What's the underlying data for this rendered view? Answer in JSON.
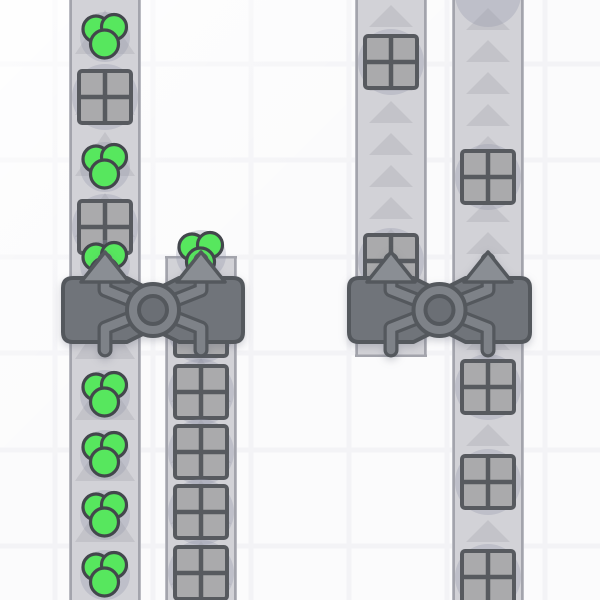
{
  "scene": {
    "canvas": {
      "width": 600,
      "height": 600
    },
    "colors": {
      "background": "#fbfbfc",
      "grid_line": "#f3f3f6",
      "belt_body": "#d2d2d7",
      "belt_edge": "#a3a4ac",
      "belt_arrow": "#c3c3c9",
      "item_shadow": "rgba(147,150,168,0.30)",
      "crate_fill": "#aaaaac",
      "crate_stroke": "#575a5f",
      "green_fill": "#57e75e",
      "green_stroke": "#43474c",
      "building_body": "#70747a",
      "building_stroke": "#54585d",
      "pipe_dark": "#54585d",
      "pipe_light": "#7e8288",
      "ring_inner_fill": "#6b6f75",
      "building_arrow_fill": "#8a8e94"
    },
    "grid": {
      "x_lines": [
        55,
        153,
        251,
        349,
        447,
        545
      ],
      "y_lines": [
        64,
        160,
        257,
        353,
        450,
        546
      ],
      "line_width": 5
    },
    "arrow_styles": {
      "large": {
        "w": 60,
        "h": 44
      },
      "small": {
        "w": 44,
        "h": 22
      }
    },
    "belts": [
      {
        "id": "belt-1",
        "x": 69,
        "width": 72,
        "y_top": 0,
        "y_bottom": 600,
        "arrow": "large",
        "spacing": 61,
        "phase": 10
      },
      {
        "id": "belt-2",
        "x": 165,
        "width": 72,
        "y_top": 256,
        "y_bottom": 600,
        "arrow": "large",
        "spacing": 61,
        "phase": 297
      },
      {
        "id": "belt-3",
        "x": 355,
        "width": 72,
        "y_top": 0,
        "y_bottom": 357,
        "arrow": "small",
        "spacing": 32,
        "phase": 5,
        "arrow_stop": 300
      },
      {
        "id": "belt-4",
        "x": 452,
        "width": 72,
        "y_top": 0,
        "y_bottom": 600,
        "arrow": "small",
        "spacing": 32,
        "phase": 8
      }
    ],
    "items": [
      {
        "type": "green",
        "x": 105,
        "y": 37
      },
      {
        "type": "crate",
        "x": 105,
        "y": 97
      },
      {
        "type": "green",
        "x": 105,
        "y": 167
      },
      {
        "type": "crate",
        "x": 105,
        "y": 227
      },
      {
        "type": "green",
        "x": 105,
        "y": 265
      },
      {
        "type": "green",
        "x": 105,
        "y": 395
      },
      {
        "type": "green",
        "x": 105,
        "y": 455
      },
      {
        "type": "green",
        "x": 105,
        "y": 515
      },
      {
        "type": "green",
        "x": 105,
        "y": 575
      },
      {
        "type": "green",
        "x": 201,
        "y": 255
      },
      {
        "type": "crate",
        "x": 201,
        "y": 330
      },
      {
        "type": "crate",
        "x": 201,
        "y": 392
      },
      {
        "type": "crate",
        "x": 201,
        "y": 452
      },
      {
        "type": "crate",
        "x": 201,
        "y": 512
      },
      {
        "type": "crate",
        "x": 201,
        "y": 573
      },
      {
        "type": "crate",
        "x": 391,
        "y": 62
      },
      {
        "type": "crate",
        "x": 391,
        "y": 261
      },
      {
        "type": "shadow",
        "x": 488,
        "y": -6
      },
      {
        "type": "crate",
        "x": 488,
        "y": 177
      },
      {
        "type": "crate",
        "x": 488,
        "y": 387
      },
      {
        "type": "crate",
        "x": 488,
        "y": 482
      },
      {
        "type": "crate",
        "x": 488,
        "y": 577
      }
    ],
    "buildings": [
      {
        "id": "crossover-left",
        "lane_a": 105,
        "lane_b": 201,
        "top": 278,
        "bottom": 342
      },
      {
        "id": "crossover-right",
        "lane_a": 391,
        "lane_b": 488,
        "top": 278,
        "bottom": 342
      }
    ],
    "building_geometry": {
      "side_extent": 42,
      "corner_radius": 10,
      "notch_half_width": 26,
      "notch_depth": 13,
      "ring_cy": 310,
      "ring_outer_r": 26,
      "ring_inner_r": 14,
      "arrow_tip_y": 252,
      "arrow_base_y": 282,
      "arrow_half_width": 24,
      "pipe_top_y": 260,
      "pipe_bottom_y": 350,
      "elbow_top_y": 290,
      "elbow_bottom_y": 328
    }
  }
}
